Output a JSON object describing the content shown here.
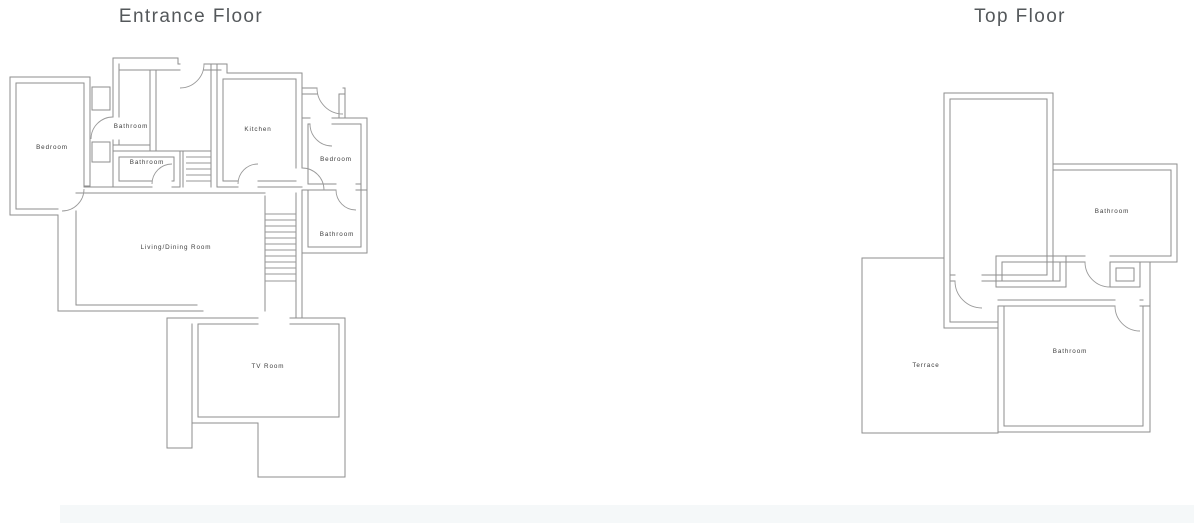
{
  "page": {
    "background": "#ffffff",
    "footer_bar_color": "#f5f8f9"
  },
  "colors": {
    "wall": "#8e8e8e",
    "room_label": "#3c3c3c",
    "title": "#54585b"
  },
  "floors": [
    {
      "id": "entrance",
      "title": "Entrance Floor",
      "title_x": 191,
      "title_y": 22,
      "rooms": [
        {
          "name": "Bedroom",
          "x": 52,
          "y": 149
        },
        {
          "name": "Bathroom",
          "x": 131,
          "y": 128
        },
        {
          "name": "Bathroom",
          "x": 147,
          "y": 164
        },
        {
          "name": "Kitchen",
          "x": 258,
          "y": 131
        },
        {
          "name": "Bedroom",
          "x": 336,
          "y": 161
        },
        {
          "name": "Bathroom",
          "x": 337,
          "y": 236
        },
        {
          "name": "Living/Dining Room",
          "x": 176,
          "y": 249
        },
        {
          "name": "TV Room",
          "x": 268,
          "y": 368
        }
      ]
    },
    {
      "id": "top",
      "title": "Top Floor",
      "title_x": 1020,
      "title_y": 22,
      "rooms": [
        {
          "name": "Bathroom",
          "x": 1112,
          "y": 213
        },
        {
          "name": "Terrace",
          "x": 926,
          "y": 367
        },
        {
          "name": "Bathroom",
          "x": 1070,
          "y": 353
        }
      ]
    }
  ]
}
